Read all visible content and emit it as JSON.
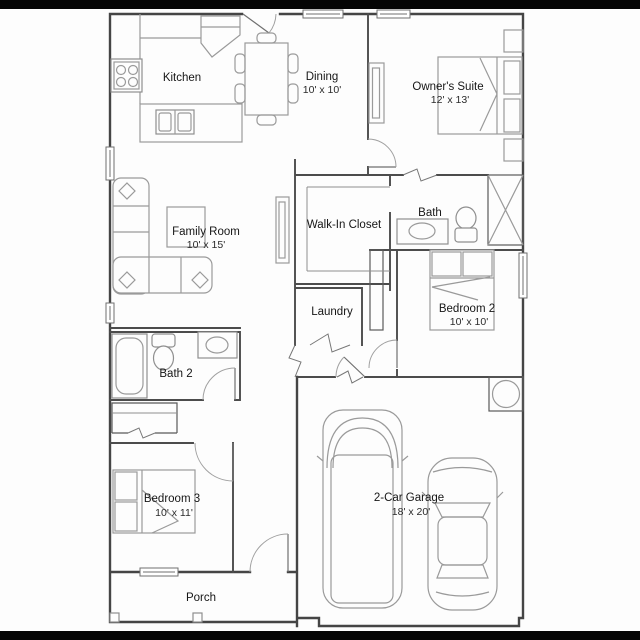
{
  "meta": {
    "type": "floor-plan",
    "background_color": "#fdfdfd",
    "letterbox_color": "#000000",
    "wall_color": "#454545",
    "furniture_color": "#9a9a9a",
    "text_color": "#161616"
  },
  "rooms": [
    {
      "id": "kitchen",
      "name": "Kitchen",
      "dims": ""
    },
    {
      "id": "dining",
      "name": "Dining",
      "dims": "10' x 10'"
    },
    {
      "id": "owners-suite",
      "name": "Owner's Suite",
      "dims": "12' x 13'"
    },
    {
      "id": "family-room",
      "name": "Family Room",
      "dims": "10' x 15'"
    },
    {
      "id": "walk-in-closet",
      "name": "Walk-In Closet",
      "dims": ""
    },
    {
      "id": "bath",
      "name": "Bath",
      "dims": ""
    },
    {
      "id": "bedroom-2",
      "name": "Bedroom 2",
      "dims": "10' x 10'"
    },
    {
      "id": "laundry",
      "name": "Laundry",
      "dims": ""
    },
    {
      "id": "bath-2",
      "name": "Bath 2",
      "dims": ""
    },
    {
      "id": "bedroom-3",
      "name": "Bedroom 3",
      "dims": "10' x 11'"
    },
    {
      "id": "garage",
      "name": "2-Car Garage",
      "dims": "18' x 20'"
    },
    {
      "id": "porch",
      "name": "Porch",
      "dims": ""
    }
  ]
}
